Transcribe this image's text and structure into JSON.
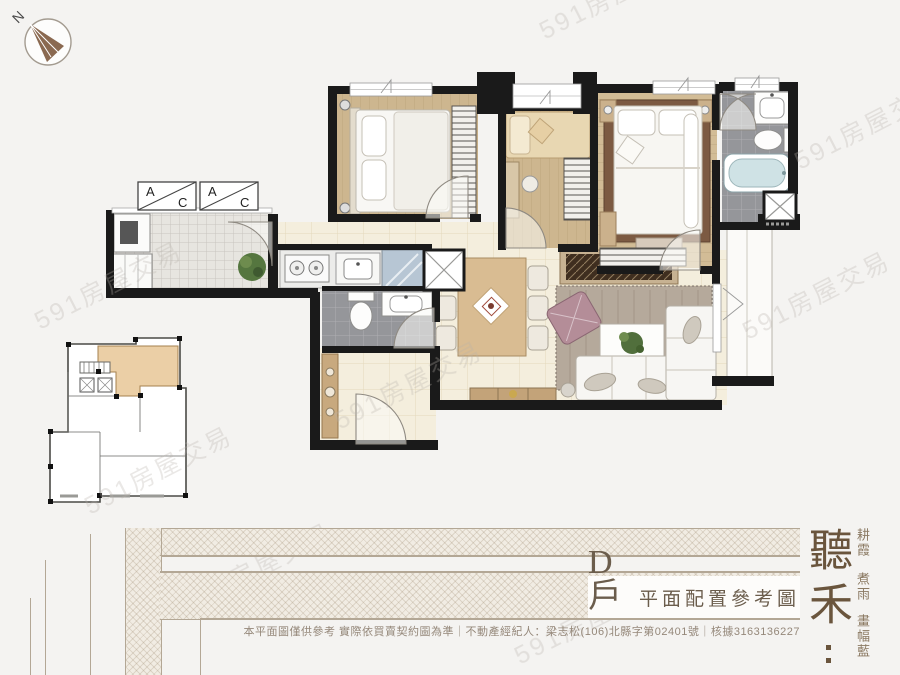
{
  "title": {
    "unit": "D戶",
    "caption": "平面配置參考圖"
  },
  "brand": {
    "name": "聽禾",
    "taglines": [
      "耕霞",
      "煮雨",
      "畫幅藍"
    ]
  },
  "footer": {
    "disclaimer": "本平面圖僅供參考 實際依買賣契約圖為準｜不動產經紀人：梁志松(106)北縣字第02401號｜核據3163136227"
  },
  "watermark": {
    "text": "591房屋交易"
  },
  "compass": {
    "north_label": "N"
  },
  "plan": {
    "ac_label_a": "A",
    "ac_label_c": "C"
  },
  "colors": {
    "wall": "#1a1a1a",
    "wood": "#cdb68f",
    "unit_highlight": "#ebcfa6",
    "brand_brown": "#6a553d",
    "tub_blue": "#cfe2e5",
    "band_line": "#b3a795"
  }
}
